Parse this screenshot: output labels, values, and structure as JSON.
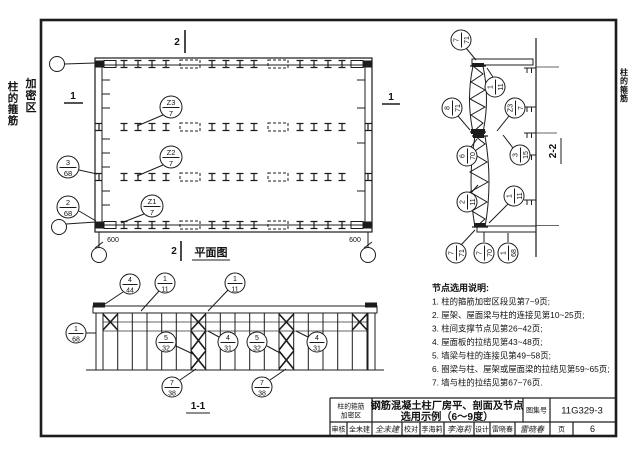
{
  "colors": {
    "ink": "#1c1c1c",
    "paper": "#ffffff"
  },
  "tabs": {
    "left_line1": "柱的箍筋",
    "left_line2": "加密区",
    "right": "柱的箍筋"
  },
  "plan": {
    "title": "平面图",
    "mark1": "1",
    "mark2": "2",
    "dim_left": "600",
    "dim_right": "600",
    "callouts": {
      "z3": {
        "top": "Z3",
        "bot": "7"
      },
      "z2": {
        "top": "Z2",
        "bot": "7"
      },
      "z1": {
        "top": "Z1",
        "bot": "7"
      },
      "n3_68": {
        "top": "3",
        "bot": "68"
      },
      "n2_68": {
        "top": "2",
        "bot": "68"
      }
    }
  },
  "section": {
    "title": "2-2",
    "callouts": {
      "n7_71a": {
        "top": "7",
        "bot": "71"
      },
      "n1_11a": {
        "top": "1",
        "bot": "11"
      },
      "z3": {
        "top": "Z3",
        "bot": "7"
      },
      "n8_71": {
        "top": "8",
        "bot": "71"
      },
      "n6_70": {
        "top": "6",
        "bot": "70"
      },
      "n3_15": {
        "top": "3",
        "bot": "15"
      },
      "n2_11": {
        "top": "2",
        "bot": "11"
      },
      "n1_11b": {
        "top": "1",
        "bot": "11"
      },
      "n7_71b": {
        "top": "7",
        "bot": "71"
      },
      "n7_70": {
        "top": "7",
        "bot": "70"
      },
      "n1_68": {
        "top": "1",
        "bot": "68"
      }
    }
  },
  "elevation": {
    "title": "1-1",
    "callouts": {
      "n4_44": {
        "top": "4",
        "bot": "44"
      },
      "n1_11a": {
        "top": "1",
        "bot": "11"
      },
      "n1_11b": {
        "top": "1",
        "bot": "11"
      },
      "n1_68": {
        "top": "1",
        "bot": "68"
      },
      "n5_32a": {
        "top": "5",
        "bot": "32"
      },
      "n4_31a": {
        "top": "4",
        "bot": "31"
      },
      "n5_32b": {
        "top": "5",
        "bot": "32"
      },
      "n4_31b": {
        "top": "4",
        "bot": "31"
      },
      "n7_38a": {
        "top": "7",
        "bot": "38"
      },
      "n7_38b": {
        "top": "7",
        "bot": "38"
      }
    }
  },
  "notes": {
    "title": "节点选用说明:",
    "items": [
      "1. 柱的箍筋加密区段见第7~9页;",
      "2. 屋架、屋面梁与柱的连接见第10~25页;",
      "3. 柱间支撑节点见第26~42页;",
      "4. 屋面板的拉结见第43~48页;",
      "5. 墙梁与柱的连接见第49~58页;",
      "6. 圈梁与柱、屋架或屋面梁的拉结见第59~65页;",
      "7. 墙与柱的拉结见第67~76页."
    ]
  },
  "title_block": {
    "category_line1": "柱的箍筋",
    "category_line2": "加密区",
    "title_line1": "钢筋混凝土柱厂房平、剖面及节点",
    "title_line2": "选用示例（6～9度）",
    "atlas_label": "图集号",
    "atlas_no": "11G329-3",
    "page_label": "页",
    "page_no": "6",
    "audit_label": "审核",
    "audit_name": "全未建",
    "check_label": "校对",
    "check_name": "李海莉",
    "design_label": "设计",
    "design_name": "雷晓春"
  }
}
